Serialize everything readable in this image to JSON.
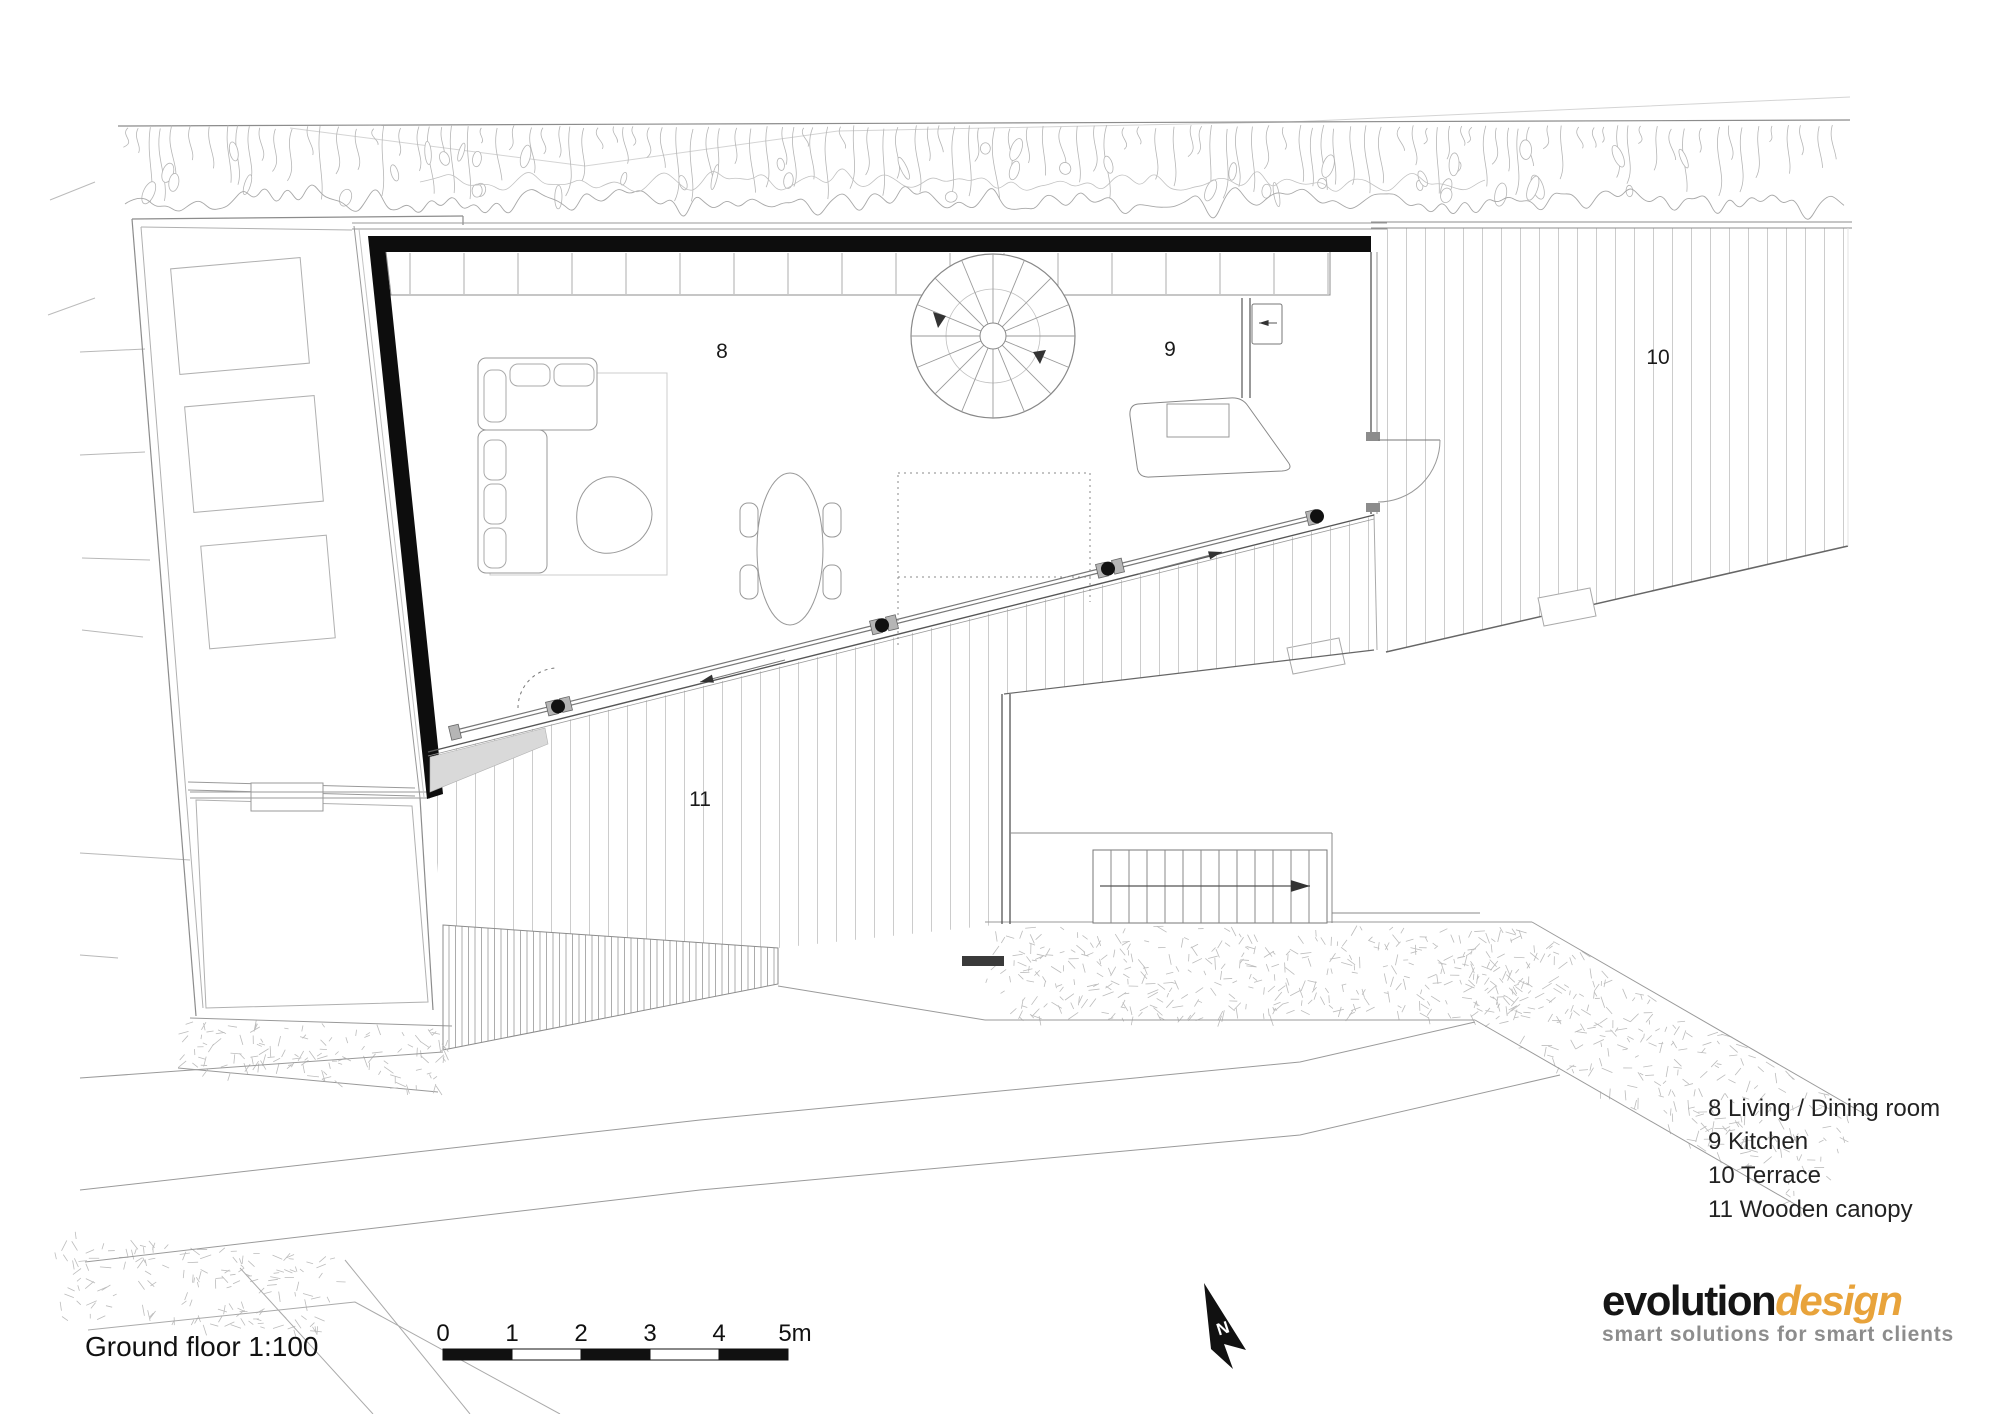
{
  "title": {
    "label": "Ground floor 1:100"
  },
  "plan_labels": {
    "living": "8",
    "kitchen": "9",
    "terrace": "10",
    "canopy": "11"
  },
  "legend": {
    "items": [
      {
        "text": "8 Living / Dining room"
      },
      {
        "text": "9 Kitchen"
      },
      {
        "text": "10 Terrace"
      },
      {
        "text": "11 Wooden canopy"
      }
    ]
  },
  "scale_bar": {
    "ticks": [
      "0",
      "1",
      "2",
      "3",
      "4",
      "5m"
    ]
  },
  "north": {
    "label": "N"
  },
  "logo": {
    "brand_primary": "evolution",
    "brand_secondary": "design",
    "tagline": "smart solutions for smart clients",
    "accent_color": "#E8A33B"
  }
}
